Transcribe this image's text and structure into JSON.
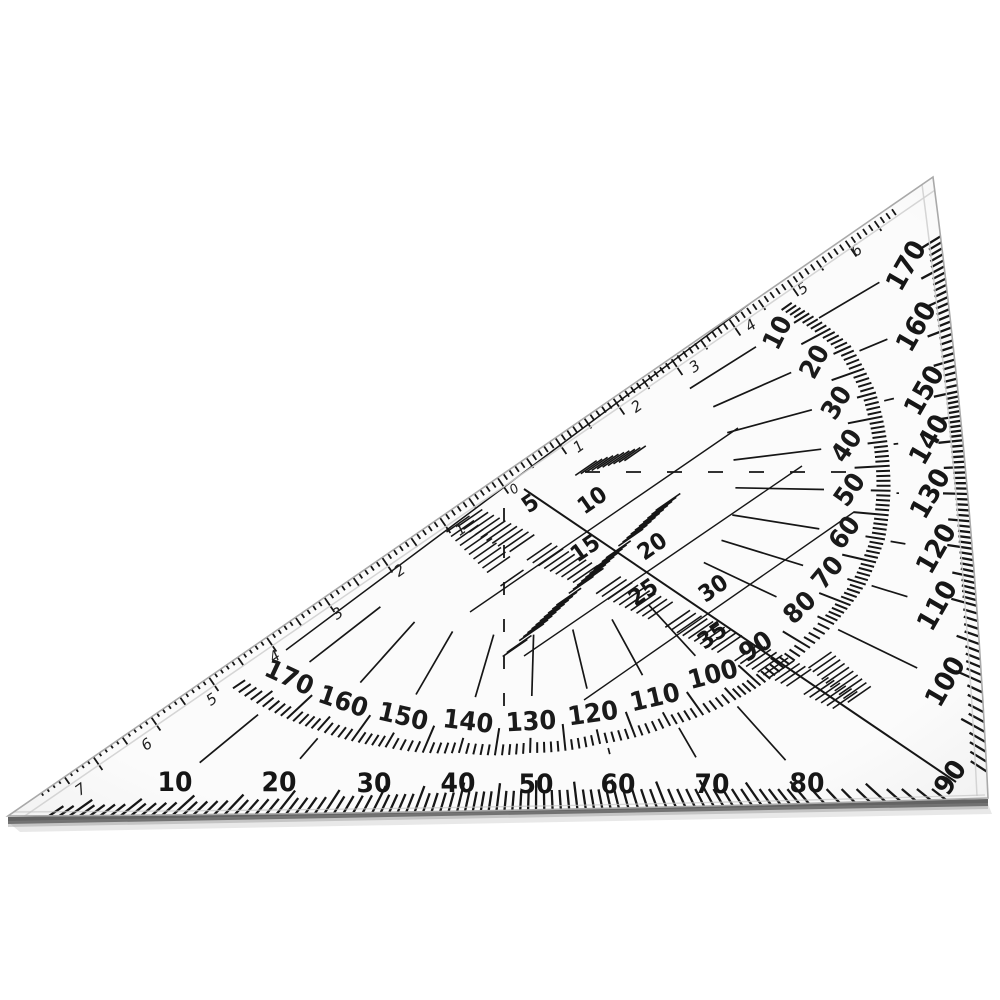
{
  "object_label": "transparent protractor set square ruler photographed on white background",
  "colors": {
    "background": "#ffffff",
    "plastic_face": "#fbfbfb",
    "plastic_edge_shade": "#f1f1f1",
    "ink": "#161616",
    "bevel_line": "#d0d0d0",
    "outline": "#a9a9a9",
    "bottom_edge_dark": "#484848",
    "shadow": "#bdbdbd"
  },
  "scales": {
    "outer_bottom_degrees": {
      "unit": "degrees",
      "tick_step": 1,
      "labels": [
        {
          "v": "10",
          "x": 175,
          "y": 783,
          "rot": 0
        },
        {
          "v": "20",
          "x": 279,
          "y": 783,
          "rot": 0
        },
        {
          "v": "30",
          "x": 374,
          "y": 784,
          "rot": 0
        },
        {
          "v": "40",
          "x": 458,
          "y": 784,
          "rot": 0
        },
        {
          "v": "50",
          "x": 536,
          "y": 785,
          "rot": 0
        },
        {
          "v": "60",
          "x": 618,
          "y": 785,
          "rot": 0
        },
        {
          "v": "70",
          "x": 712,
          "y": 785,
          "rot": 0
        },
        {
          "v": "80",
          "x": 807,
          "y": 784,
          "rot": 0
        },
        {
          "v": "90",
          "x": 951,
          "y": 778,
          "rot": -56
        }
      ]
    },
    "outer_right_degrees": {
      "unit": "degrees",
      "tick_step": 1,
      "label_rotation": -60,
      "labels": [
        {
          "v": "100",
          "x": 946,
          "y": 682
        },
        {
          "v": "110",
          "x": 938,
          "y": 606
        },
        {
          "v": "120",
          "x": 937,
          "y": 549
        },
        {
          "v": "130",
          "x": 931,
          "y": 494
        },
        {
          "v": "140",
          "x": 930,
          "y": 440
        },
        {
          "v": "150",
          "x": 925,
          "y": 391
        },
        {
          "v": "160",
          "x": 917,
          "y": 327
        },
        {
          "v": "170",
          "x": 907,
          "y": 266
        }
      ]
    },
    "protractor_arc": {
      "unit": "degrees",
      "range": [
        10,
        170
      ],
      "tick_step": 1,
      "labels": [
        {
          "v": "10",
          "x": 778,
          "y": 333,
          "rot": -63
        },
        {
          "v": "20",
          "x": 815,
          "y": 362,
          "rot": -61
        },
        {
          "v": "30",
          "x": 837,
          "y": 403,
          "rot": -58
        },
        {
          "v": "40",
          "x": 847,
          "y": 446,
          "rot": -56
        },
        {
          "v": "50",
          "x": 850,
          "y": 490,
          "rot": -55
        },
        {
          "v": "60",
          "x": 845,
          "y": 533,
          "rot": -54
        },
        {
          "v": "70",
          "x": 828,
          "y": 573,
          "rot": -50
        },
        {
          "v": "80",
          "x": 800,
          "y": 608,
          "rot": -44
        },
        {
          "v": "90",
          "x": 756,
          "y": 647,
          "rot": -33
        },
        {
          "v": "100",
          "x": 713,
          "y": 675,
          "rot": -15
        },
        {
          "v": "110",
          "x": 655,
          "y": 698,
          "rot": -13
        },
        {
          "v": "120",
          "x": 593,
          "y": 714,
          "rot": -8
        },
        {
          "v": "130",
          "x": 531,
          "y": 722,
          "rot": -3
        },
        {
          "v": "140",
          "x": 468,
          "y": 722,
          "rot": 7
        },
        {
          "v": "150",
          "x": 403,
          "y": 717,
          "rot": 13
        },
        {
          "v": "160",
          "x": 343,
          "y": 702,
          "rot": 19
        },
        {
          "v": "170",
          "x": 289,
          "y": 678,
          "rot": 25
        }
      ]
    },
    "center_mm_grid": {
      "unit": "mm",
      "label_rotation": -35,
      "labels": [
        {
          "v": "5",
          "x": 530,
          "y": 503
        },
        {
          "v": "10",
          "x": 592,
          "y": 500
        },
        {
          "v": "15",
          "x": 585,
          "y": 548
        },
        {
          "v": "20",
          "x": 652,
          "y": 546
        },
        {
          "v": "25",
          "x": 643,
          "y": 592
        },
        {
          "v": "30",
          "x": 713,
          "y": 588
        },
        {
          "v": "35",
          "x": 712,
          "y": 635
        }
      ]
    },
    "hypotenuse_cm_ruler": {
      "unit": "cm",
      "label_rotation": -35,
      "zero": {
        "v": "0",
        "x": 512,
        "y": 486
      },
      "cm_toward_apex": [
        {
          "v": "1",
          "x": 577,
          "y": 444
        },
        {
          "v": "2",
          "x": 635,
          "y": 404
        },
        {
          "v": "3",
          "x": 693,
          "y": 364
        },
        {
          "v": "4",
          "x": 749,
          "y": 323
        },
        {
          "v": "5",
          "x": 801,
          "y": 286
        },
        {
          "v": "6",
          "x": 855,
          "y": 248
        }
      ],
      "cm_toward_tip": [
        {
          "v": "1",
          "x": 459,
          "y": 527
        },
        {
          "v": "2",
          "x": 398,
          "y": 568
        },
        {
          "v": "3",
          "x": 336,
          "y": 611
        },
        {
          "v": "4",
          "x": 273,
          "y": 654
        },
        {
          "v": "5",
          "x": 210,
          "y": 697
        },
        {
          "v": "6",
          "x": 145,
          "y": 742
        },
        {
          "v": "7",
          "x": 79,
          "y": 787
        }
      ]
    }
  }
}
